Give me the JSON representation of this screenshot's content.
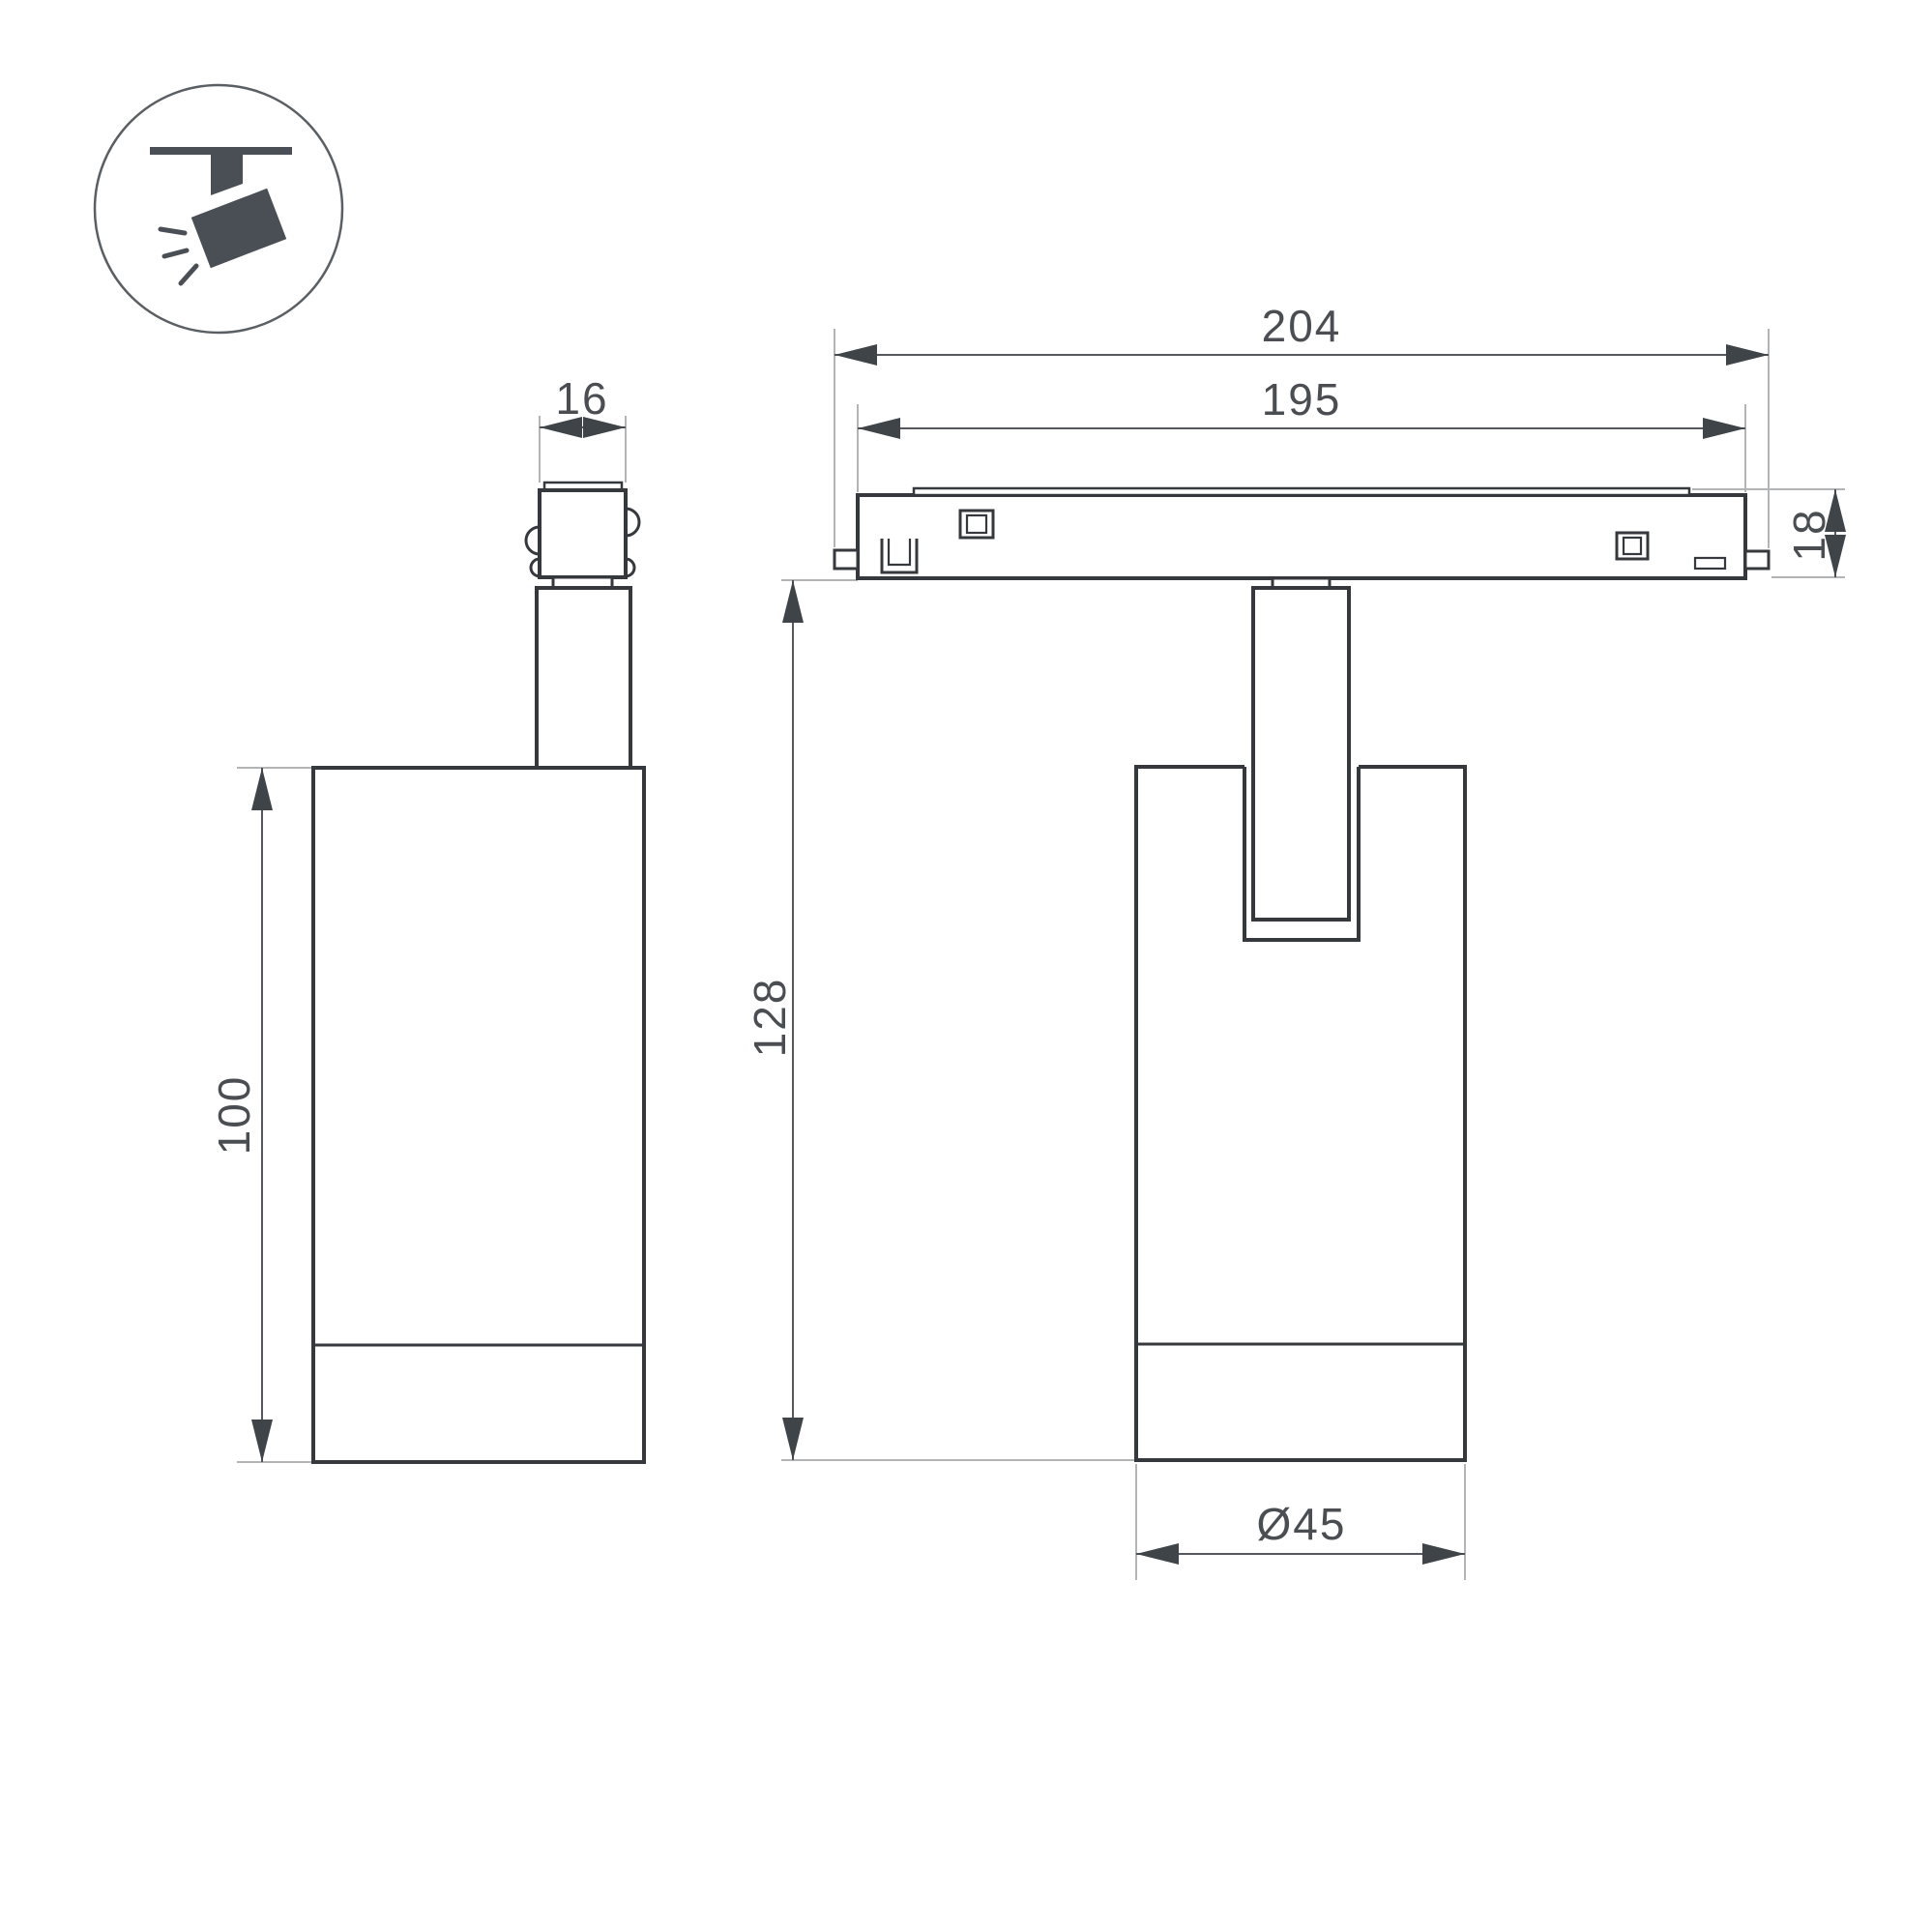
{
  "colors": {
    "background": "#ffffff",
    "outline": "#35393d",
    "dimension_line": "#55595d",
    "extension_line": "#b2b4b6",
    "dimension_text": "#4a4e52",
    "icon_fill": "#4a4f55"
  },
  "icon": {
    "name": "ceiling-track-spotlight-icon"
  },
  "views": {
    "side": {
      "adapter_width_dim": "16",
      "body_height_dim": "100"
    },
    "front": {
      "overall_length_dim": "204",
      "rail_length_dim": "195",
      "track_height_dim": "18",
      "overall_height_dim": "128",
      "body_diameter_dim": "Ø45"
    }
  }
}
